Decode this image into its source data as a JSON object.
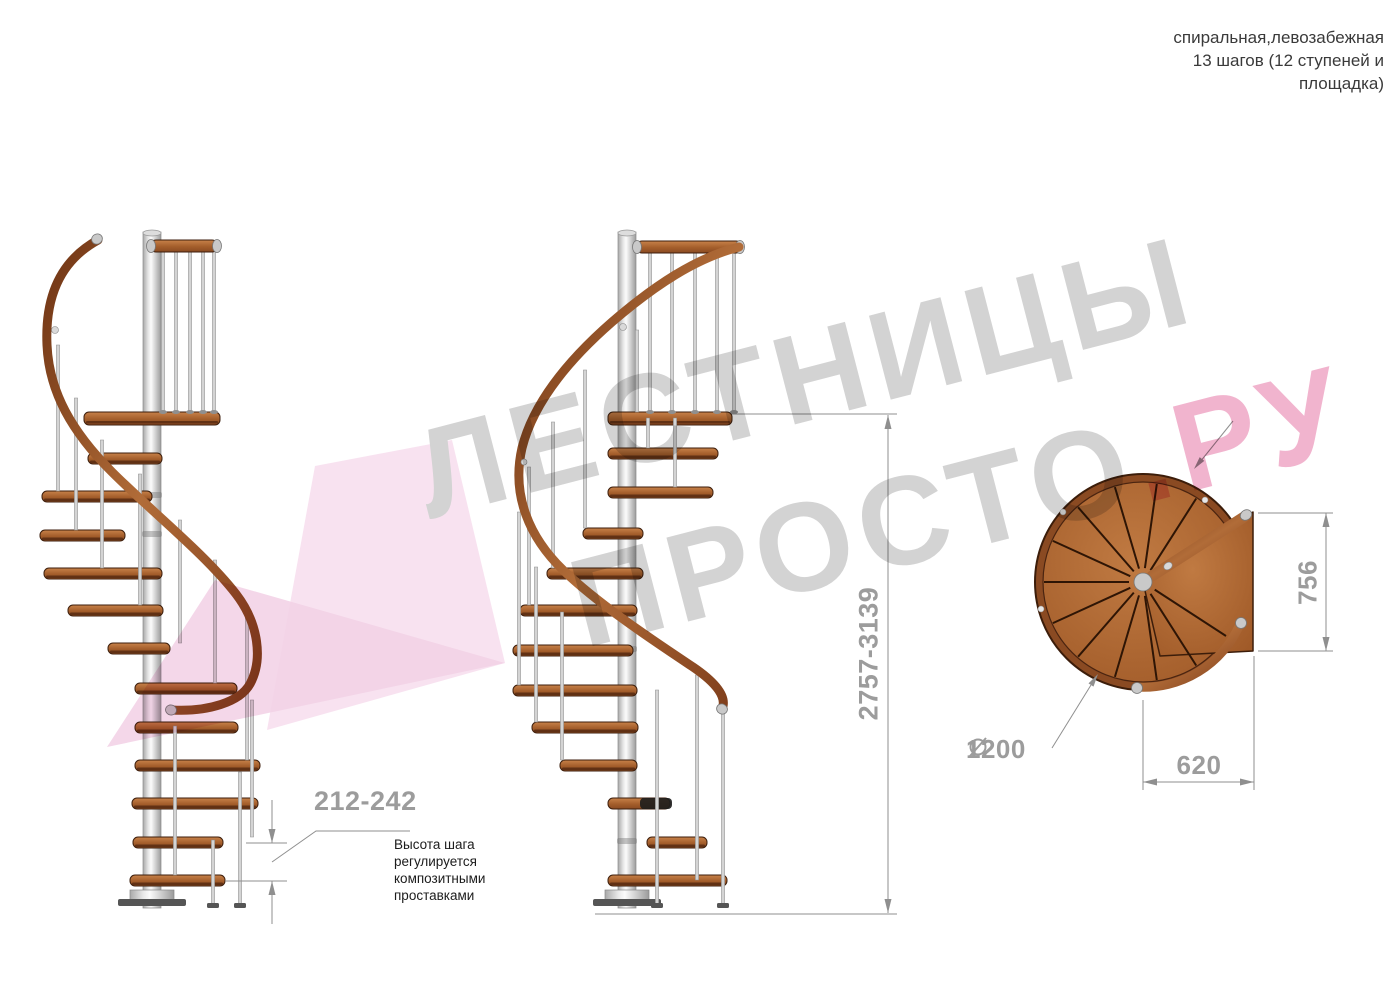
{
  "header": {
    "title": "спиральная,левозабежная\n13 шагов (12 ступеней и\nплощадка)"
  },
  "side_view": {
    "step_height_dim": "212-242",
    "step_height_note": "Высота шага\nрегулируется\nкомпозитными\nпроставками",
    "total_height_dim": "2757-3139"
  },
  "top_view": {
    "depth_dim": "756",
    "width_dim": "620",
    "diameter_symbol": "diameter-icon",
    "diameter_dim": "1200"
  },
  "watermark": {
    "line1": "ЛЕСТНИЦЫ",
    "line2_gray": "ПРОСТО",
    "line2_pink": ".РУ"
  },
  "colors": {
    "dim": "#9c9c9c",
    "dimline": "#8f8f8f",
    "text": "#3a3a3a",
    "note": "#1c1c1c",
    "wood": "#b06a35",
    "wood-dark": "#7e3d1b",
    "rail-brown": "#8a4520",
    "metal": "#d4d4d4",
    "wmgray": "#d3d3d3",
    "wmpink": "#f1b4ce",
    "arrowpink1": "#f7dfee",
    "arrowpink2": "#f3d3e7"
  }
}
